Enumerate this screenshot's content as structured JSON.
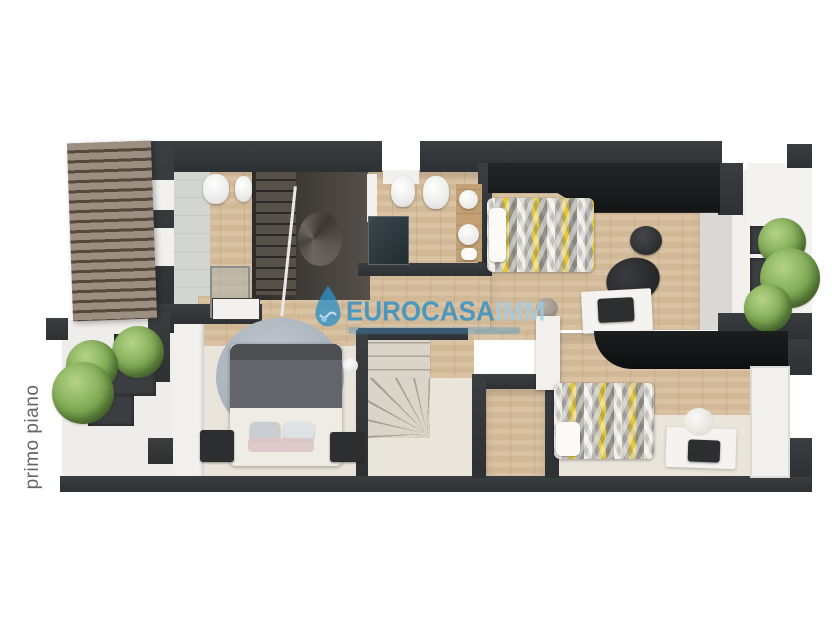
{
  "floor_label": "primo piano",
  "watermark": {
    "logo_icon": "water-droplet-icon",
    "brand": "EUROCASA",
    "brand_suffix": "IMM"
  },
  "colors": {
    "background": "#ffffff",
    "wall": "#35383b",
    "wood_floor": "#d8bf9d",
    "brand_blue": "#2e8fc4",
    "brand_blue_light": "#a3cbe5",
    "bed_accent_yellow": "#e3c83d",
    "plant_green": "#7aa750",
    "label_gray": "#666666"
  }
}
